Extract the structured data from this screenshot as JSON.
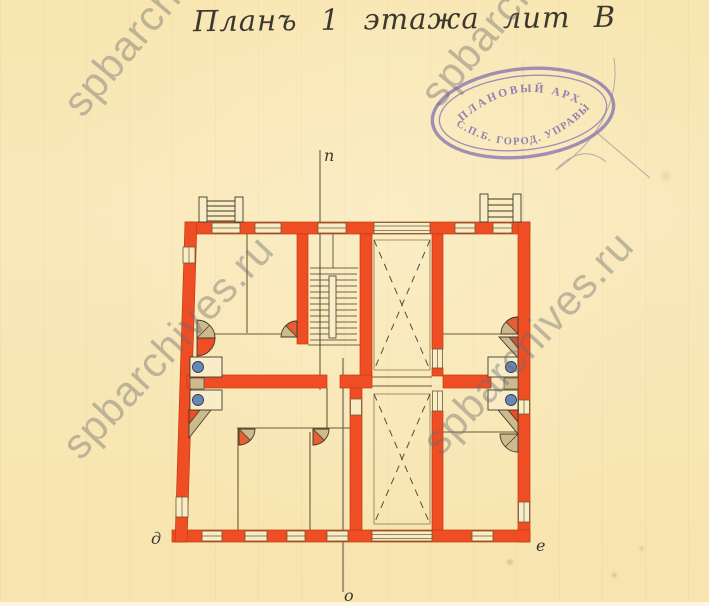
{
  "document": {
    "title": "Планъ 1 этажа лит В",
    "plan_labels": {
      "section_top": "п",
      "section_bottom": "о",
      "corner_bottom_left": "д",
      "corner_bottom_right": "е"
    },
    "stamp": {
      "arc_top": "ПЛАНОВЫЙ АРХ.",
      "arc_bottom": "С.П.Б. ГОРОД. УПРАВЫ"
    },
    "watermark": {
      "text": "spbarchives.ru"
    },
    "colors": {
      "paper": "#f8e6b0",
      "wall": "#ef4d24",
      "wall_edge": "#c03d10",
      "line": "#6b5c33",
      "dark": "#3f3a2c",
      "ink": "#3c3830",
      "room": "#f9edc8",
      "stove_tan": "#cdb98c",
      "fixture_blue": "#6a86b5",
      "stamp": "#7a68b0",
      "watermark": "#6e6e6e"
    }
  }
}
